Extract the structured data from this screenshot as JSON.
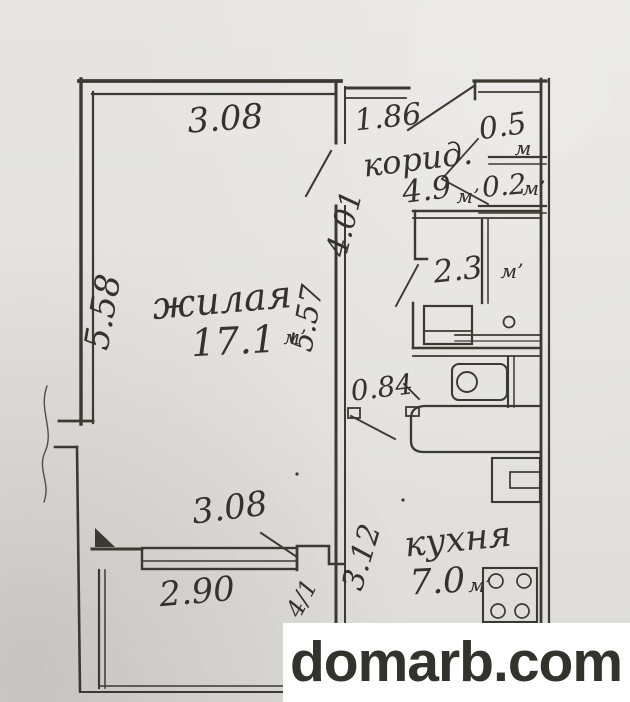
{
  "watermark": {
    "text": "domarb.com",
    "color": "#9a1416",
    "background": "#ffffff"
  },
  "colors": {
    "paper": "#e3e2de",
    "ink": "#3b3931"
  },
  "rooms": {
    "living": {
      "name": "жилая",
      "area": "17.1",
      "unit": "м’"
    },
    "corridor": {
      "name": "корид.",
      "area": "4.9",
      "unit": "м’"
    },
    "kitchen": {
      "name": "кухня",
      "area": "7.0",
      "unit": "м’"
    },
    "bathroom": {
      "area": "2.3",
      "unit": "м’"
    },
    "closet_large": {
      "area": "0.5",
      "unit": "м"
    },
    "closet_small": {
      "area": "0.2",
      "unit": "м’"
    }
  },
  "dimensions": {
    "living_top_width": "3.08",
    "corridor_top_width": "1.86",
    "living_left_height": "5.58",
    "living_right_height": "5.57",
    "corridor_height": "4.01",
    "passage_width": "0.84",
    "living_bottom_width": "3.08",
    "balcony_width": "2.90",
    "kitchen_height": "3.12",
    "door_mark": "4/1"
  }
}
